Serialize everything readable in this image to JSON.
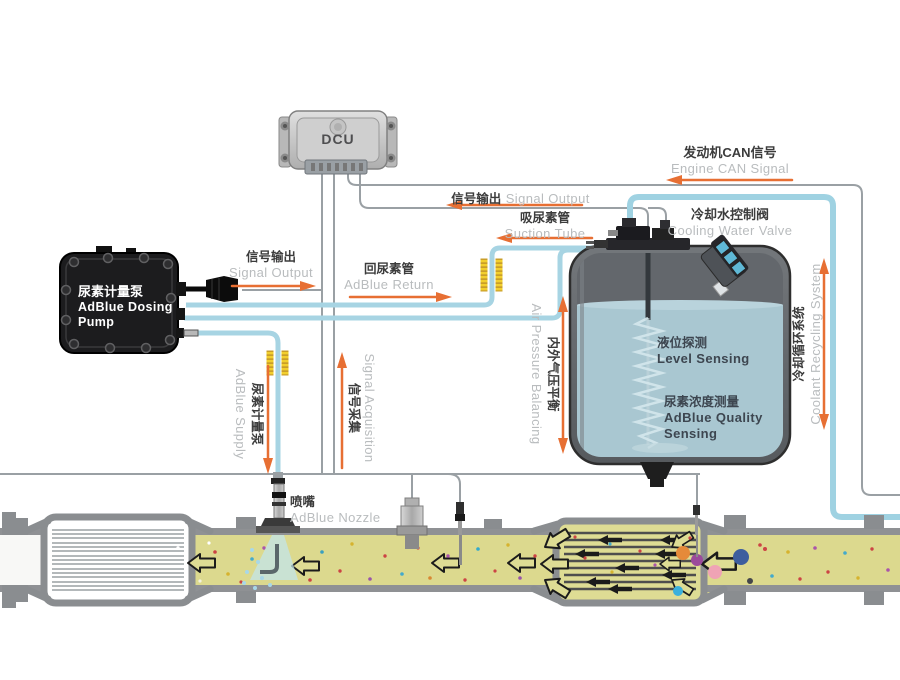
{
  "components": {
    "dcu": {
      "label": "DCU"
    },
    "pump": {
      "cn": "尿素计量泵",
      "en_line1": "AdBlue Dosing",
      "en_line2": "Pump"
    },
    "tank": {
      "level": {
        "cn": "液位探测",
        "en": "Level Sensing"
      },
      "quality": {
        "cn": "尿素浓度测量",
        "en_line1": "AdBlue Quality",
        "en_line2": "Sensing"
      }
    },
    "nozzle": {
      "cn": "喷嘴",
      "en": "AdBlue Nozzle"
    }
  },
  "lines": {
    "pump_signal_output": {
      "cn": "信号输出",
      "en": "Signal Output",
      "direction": "right"
    },
    "adblue_return": {
      "cn": "回尿素管",
      "en": "AdBlue Return",
      "direction": "right"
    },
    "suction_tube": {
      "cn": "吸尿素管",
      "en": "Suction Tube",
      "direction": "left"
    },
    "tank_signal_output": {
      "cn": "信号输出",
      "en": "Signal Output",
      "direction": "left"
    },
    "engine_can_signal": {
      "cn": "发动机CAN信号",
      "en": "Engine CAN Signal",
      "direction": "left"
    },
    "cooling_water_valve": {
      "cn": "冷却水控制阀",
      "en": "Cooling Water Valve"
    },
    "coolant_recycling": {
      "cn": "冷却循环系统",
      "en": "Coolant Recycling System",
      "direction": "both"
    },
    "air_pressure_balancing": {
      "cn": "内外气压平衡",
      "en": "Air Pressure Balancing",
      "direction": "both"
    },
    "adblue_supply": {
      "cn": "尿素计量泵",
      "en": "AdBlue Supply",
      "direction": "down"
    },
    "signal_acquisition": {
      "cn": "信号采集",
      "en": "Signal Acquisition",
      "direction": "up"
    }
  },
  "colors": {
    "fluid_line": "#a7d4e3",
    "signal_line": "#9aa0a4",
    "arrow_orange": "#e76f33",
    "exhaust_gas": "#dcd98e",
    "tank_liquid": "#a9c7d1",
    "heater_yellow": "#f2cf2e"
  }
}
